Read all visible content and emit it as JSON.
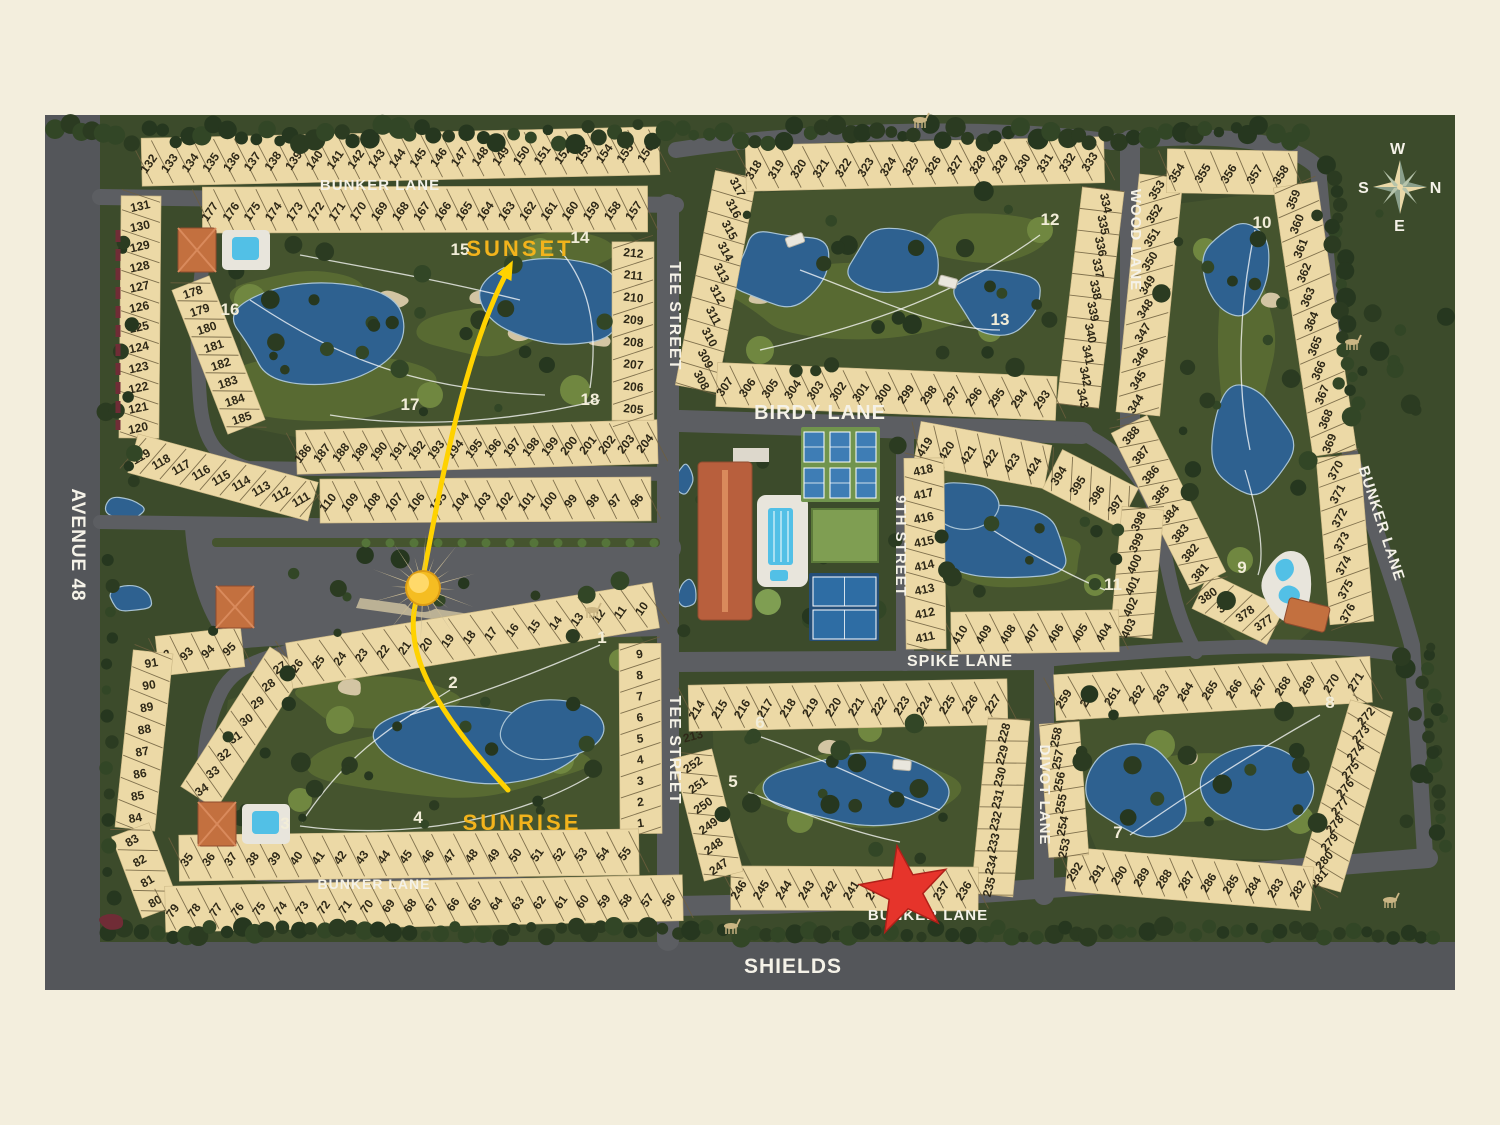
{
  "palette": {
    "cream": "#f3eedd",
    "base_green": "#3c4b2b",
    "core_green": "#45542e",
    "fairway": "#5a6d33",
    "tee_green": "#708740",
    "sand": "#d3c5a3",
    "water": "#2e6190",
    "water_edge": "#a8c3d4",
    "road": "#5c5e62",
    "road_dark": "#54565a",
    "lot_tan": "#ecd9a6",
    "lot_tick": "#6e5f3e",
    "lot_text": "#2e2817",
    "label_white": "#f5f2e8",
    "gold": "#f2b31c",
    "sun_yellow": "#ffd200",
    "star_red": "#e6342b",
    "roof_orange": "#c3703f",
    "roof_ridge": "#d98a5c",
    "pool_blue": "#52c0e6",
    "deck_white": "#e8e5dc",
    "tree_dark": "#2b3b21",
    "tree_mid": "#324626",
    "tree_deep": "#26371f",
    "palm": "#55743a",
    "hedge_red": "#702c36",
    "ray_tan": "#cbbd96",
    "compass_n": "#ee9668",
    "court_blue": "#3e7db5",
    "tennis_navy": "#244e78",
    "court_green": "#71944d",
    "lawn": "#7f9e52"
  },
  "streets": [
    {
      "id": "avenue-48",
      "label": "AVENUE 48"
    },
    {
      "id": "shields",
      "label": "SHIELDS"
    },
    {
      "id": "bunker-lane-top",
      "label": "BUNKER LANE"
    },
    {
      "id": "bunker-lane-right",
      "label": "BUNKER LANE"
    },
    {
      "id": "bunker-lane-bottom",
      "label": "BUNKER LANE"
    },
    {
      "id": "bunker-lane-bottom-left",
      "label": "BUNKER LANE"
    },
    {
      "id": "tee-street-upper",
      "label": "TEE STREET"
    },
    {
      "id": "tee-street-lower",
      "label": "TEE STREET"
    },
    {
      "id": "birdy-lane",
      "label": "BIRDY LANE"
    },
    {
      "id": "wood-lane",
      "label": "WOOD LANE"
    },
    {
      "id": "ninth-street",
      "label": "9TH STREET"
    },
    {
      "id": "spike-lane",
      "label": "SPIKE LANE"
    },
    {
      "id": "divot-lane",
      "label": "DIVOT LANE"
    }
  ],
  "sun_path_labels": {
    "sunset": "SUNSET",
    "sunrise": "SUNRISE"
  },
  "compass": {
    "w": "W",
    "n": "N",
    "e": "E",
    "s": "S"
  },
  "holes": [
    "1",
    "2",
    "3",
    "4",
    "5",
    "6",
    "7",
    "8",
    "9",
    "10",
    "11",
    "12",
    "13",
    "14",
    "15",
    "16",
    "17",
    "18"
  ],
  "lot_strips": [
    {
      "id": "a-outer-top",
      "from": 132,
      "to": 156
    },
    {
      "id": "a-outer-left",
      "from": 131,
      "to": 120
    },
    {
      "id": "a-outer-bend",
      "from": 119,
      "to": 111
    },
    {
      "id": "a-outer-bottom",
      "from": 110,
      "to": 96
    },
    {
      "id": "a-inner-top",
      "from": 177,
      "to": 157
    },
    {
      "id": "a-inner-left",
      "from": 178,
      "to": 185
    },
    {
      "id": "a-inner-bottom",
      "from": 186,
      "to": 204
    },
    {
      "id": "a-inner-right",
      "from": 212,
      "to": 205
    },
    {
      "id": "b-west",
      "from": 317,
      "to": 308
    },
    {
      "id": "b-top",
      "from": 318,
      "to": 333
    },
    {
      "id": "b-east",
      "from": 334,
      "to": 343
    },
    {
      "id": "b-bottom",
      "from": 307,
      "to": 293
    },
    {
      "id": "c-west-upper",
      "from": 353,
      "to": 344
    },
    {
      "id": "c-top",
      "from": 354,
      "to": 358
    },
    {
      "id": "c-east-upper",
      "from": 359,
      "to": 369
    },
    {
      "id": "c-east-lower",
      "from": 370,
      "to": 376
    },
    {
      "id": "c-bend",
      "from": 377,
      "to": 380
    },
    {
      "id": "c-west-lower",
      "from": 381,
      "to": 388
    },
    {
      "id": "d-top",
      "from": 419,
      "to": 424
    },
    {
      "id": "d-ne-diag",
      "from": 394,
      "to": 397
    },
    {
      "id": "d-east",
      "from": 398,
      "to": 403
    },
    {
      "id": "d-bottom",
      "from": 410,
      "to": 404
    },
    {
      "id": "d-west",
      "from": 418,
      "to": 411
    },
    {
      "id": "e-corner",
      "from": 213,
      "to": 213
    },
    {
      "id": "e-top",
      "from": 214,
      "to": 227
    },
    {
      "id": "e-east",
      "from": 228,
      "to": 235
    },
    {
      "id": "e-bottom",
      "from": 246,
      "to": 236
    },
    {
      "id": "e-west",
      "from": 252,
      "to": 247
    },
    {
      "id": "f-top",
      "from": 259,
      "to": 271
    },
    {
      "id": "f-east",
      "from": 272,
      "to": 281
    },
    {
      "id": "f-bottom",
      "from": 292,
      "to": 282
    },
    {
      "id": "f-west",
      "from": 258,
      "to": 253
    },
    {
      "id": "g-outer-bend-top",
      "from": 92,
      "to": 95
    },
    {
      "id": "g-outer-left",
      "from": 91,
      "to": 84
    },
    {
      "id": "g-outer-bend-bottom",
      "from": 83,
      "to": 80
    },
    {
      "id": "g-outer-bottom",
      "from": 79,
      "to": 56
    },
    {
      "id": "g-inner-west",
      "from": 27,
      "to": 34
    },
    {
      "id": "g-inner-top",
      "from": 26,
      "to": 10
    },
    {
      "id": "g-inner-east",
      "from": 9,
      "to": 1
    },
    {
      "id": "g-inner-bottom",
      "from": 35,
      "to": 55
    }
  ],
  "icons": {
    "sun": "sun-icon",
    "star": "location-star-icon",
    "compass": "compass-rose-icon"
  }
}
